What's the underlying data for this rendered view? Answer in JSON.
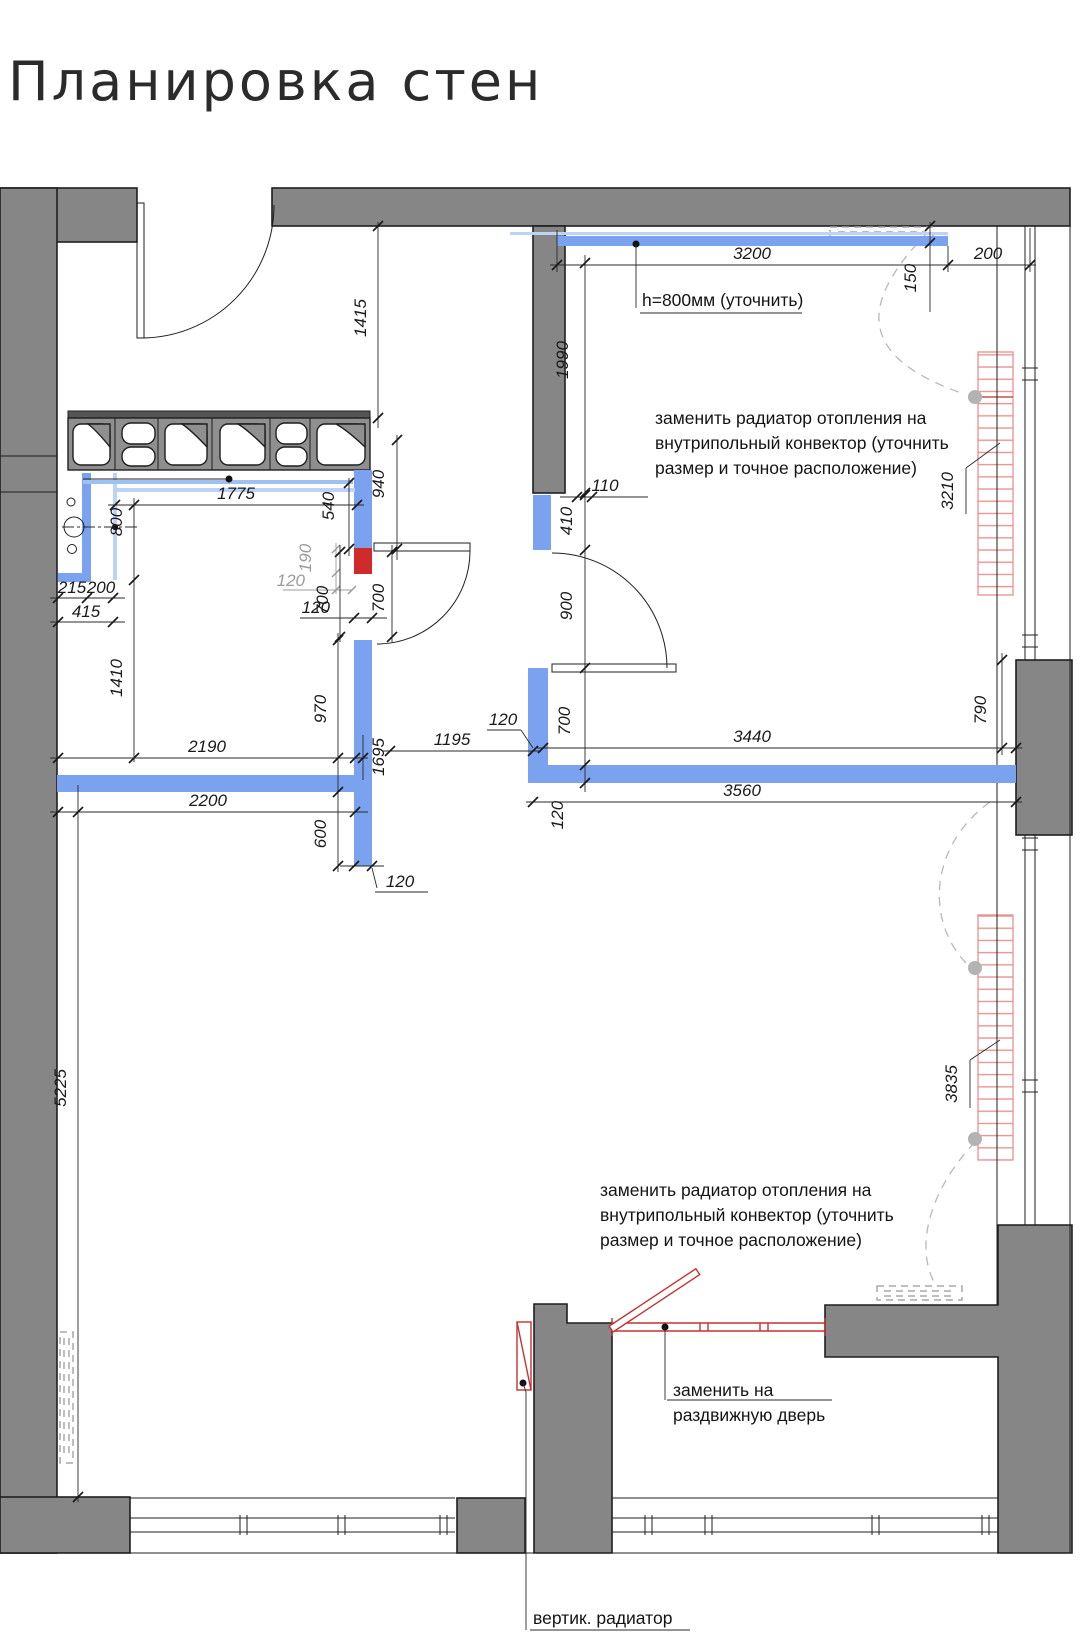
{
  "title": "Планировка стен",
  "colors": {
    "wall": "#868686",
    "new_wall": "#7ba2ee",
    "new_wall_light": "#bcd2f6",
    "accent_red": "#cf2b2b",
    "radiator_hatch": "#e89090",
    "door_red": "#c23333",
    "dashed_gray": "#a9a9a9",
    "dim_text": "#1a1a1a",
    "dim_text_gray": "#9b9b9b"
  },
  "notes": {
    "height_note": "h=800мм (уточнить)",
    "conv": [
      "заменить радиатор отопления на",
      "внутрипольный конвектор (уточнить",
      "размер и точное расположение)"
    ],
    "sliding": [
      "заменить на",
      "раздвижную дверь"
    ],
    "vert_rad": "вертик. радиатор"
  },
  "dims": {
    "d1415": "1415",
    "d3200": "3200",
    "d200a": "200",
    "d150": "150",
    "d1990": "1990",
    "d1775": "1775",
    "d940": "940",
    "d800": "800",
    "d540": "540",
    "d190": "190",
    "d120a": "120",
    "d700a": "700",
    "d700b": "700",
    "d120b": "120",
    "d215": "215",
    "d200b": "200",
    "d415": "415",
    "d1410": "1410",
    "d2190": "2190",
    "d2200": "2200",
    "d970": "970",
    "d1695": "1695",
    "d600": "600",
    "d120c": "120",
    "d5225": "5225",
    "d110": "110",
    "d410": "410",
    "d900": "900",
    "d700c": "700",
    "d120d": "120",
    "d1195": "1195",
    "d120e": "120",
    "d3440": "3440",
    "d3560": "3560",
    "d790": "790",
    "d3210": "3210",
    "d3835": "3835"
  }
}
